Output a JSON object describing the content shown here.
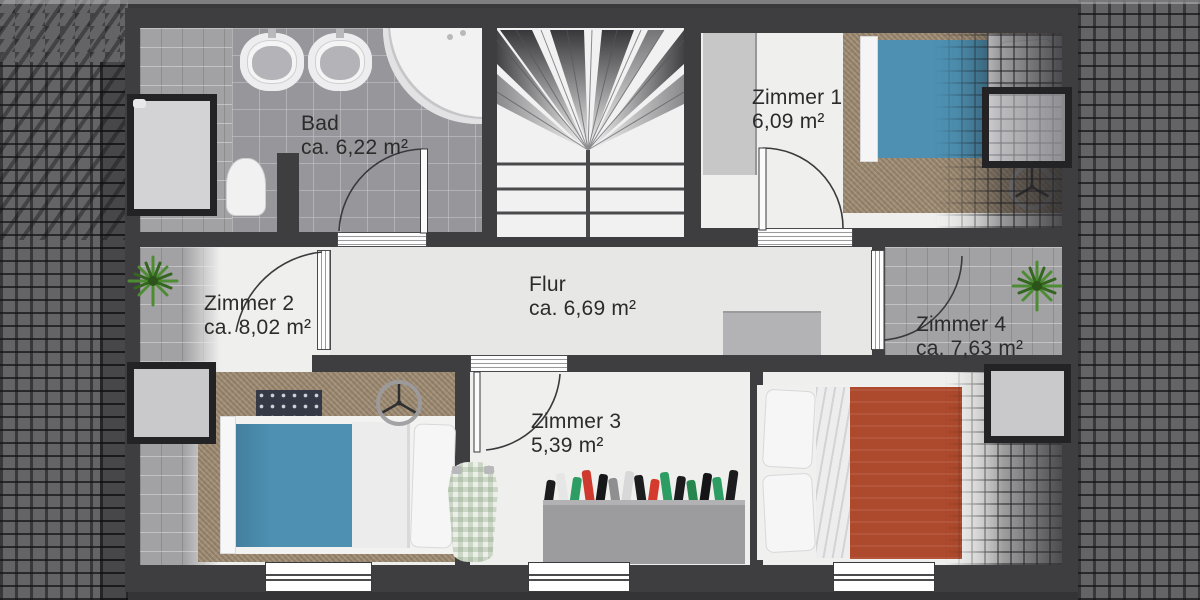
{
  "plan_type": "floor-plan",
  "rooms": [
    {
      "name": "Bad",
      "area": "ca. 6,22 m²"
    },
    {
      "name": "Zimmer 1",
      "area": "6,09 m²"
    },
    {
      "name": "Zimmer 2",
      "area": "ca. 8,02 m²"
    },
    {
      "name": "Flur",
      "area": "ca. 6,69 m²"
    },
    {
      "name": "Zimmer 3",
      "area": "5,39 m²"
    },
    {
      "name": "Zimmer 4",
      "area": "ca. 7,63 m²"
    }
  ],
  "colors": {
    "wall": "#3e3e40",
    "blanket_blue": "#4d90b2",
    "blanket_red": "#ad492c",
    "carpet_brown": "#a29078",
    "plant_green": "#4d8a33",
    "bath_tile_gray": "#97979b"
  },
  "closet": {
    "items": [
      "#1c1c1e",
      "#e6e6e6",
      "#2e9d63",
      "#cf3a2e",
      "#17171a",
      "#8f8f91",
      "#d8d8d8",
      "#1c1c1e",
      "#d43b2c",
      "#2e9d63",
      "#1c1c1e",
      "#27854e",
      "#151517",
      "#2e9d63",
      "#1c1c1e"
    ]
  }
}
